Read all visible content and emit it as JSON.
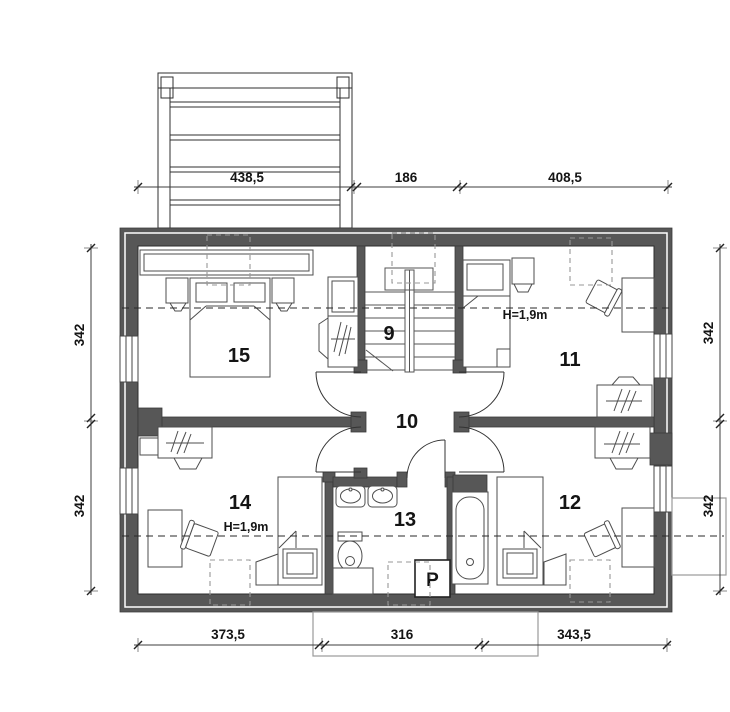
{
  "drawing": {
    "type": "attic-floor-plan",
    "rooms": {
      "r9": "9",
      "r10": "10",
      "r11": "11",
      "r12": "12",
      "r13": "13",
      "r14": "14",
      "r15": "15"
    },
    "annotations": {
      "knee_height_room11": "H=1,9m",
      "knee_height_room14": "H=1,9m",
      "washing_machine": "P"
    },
    "dimensions": {
      "top": [
        "438,5",
        "186",
        "408,5"
      ],
      "bottom": [
        "373,5",
        "316",
        "343,5"
      ],
      "left": [
        "342",
        "342"
      ],
      "right": [
        "342",
        "342"
      ]
    },
    "colors": {
      "wall": "#575757",
      "line": "#1f1f1f",
      "dashed": "#979797",
      "background": "#ffffff"
    }
  }
}
